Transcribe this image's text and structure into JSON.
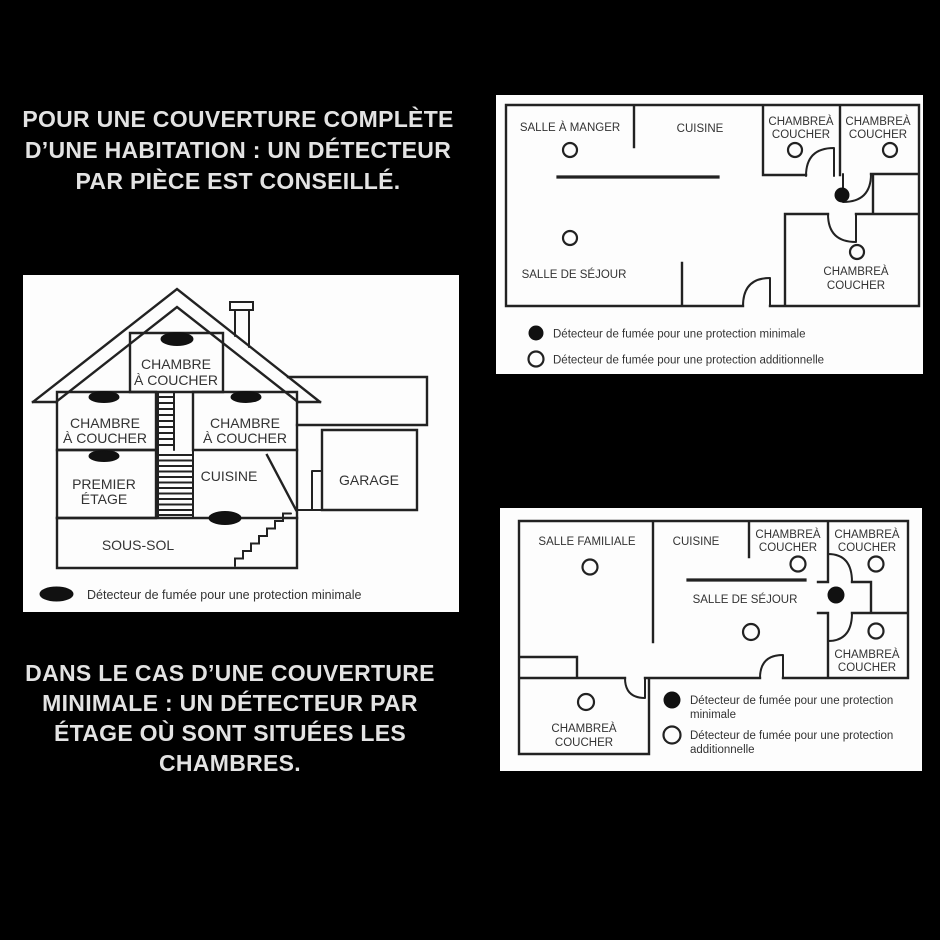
{
  "headline_top": {
    "lines": [
      "POUR UNE COUVERTURE COMPLÈTE",
      "D’UNE HABITATION : UN DÉTECTEUR",
      "PAR PIÈCE EST CONSEILLÉ."
    ]
  },
  "headline_bottom": {
    "lines": [
      "DANS LE CAS D’UNE COUVERTURE",
      "MINIMALE : UN DÉTECTEUR PAR",
      "ÉTAGE OÙ SONT SITUÉES LES",
      "CHAMBRES."
    ]
  },
  "plan_top": {
    "room_dining": "SALLE À MANGER",
    "room_kitchen": "CUISINE",
    "bedroom_line1": "CHAMBREÀ",
    "bedroom_line2": "COUCHER",
    "room_living": "SALLE DE SÉJOUR",
    "legend_minimal": "Détecteur de fumée pour une protection minimale",
    "legend_additional": "Détecteur de fumée pour une protection additionnelle"
  },
  "house": {
    "bedroom_line1": "CHAMBRE",
    "bedroom_line2": "À COUCHER",
    "first_floor_line1": "PREMIER",
    "first_floor_line2": "ÉTAGE",
    "room_kitchen": "CUISINE",
    "room_garage": "GARAGE",
    "room_basement": "SOUS-SOL",
    "legend_minimal": "Détecteur de fumée pour une protection minimale"
  },
  "plan_bottom": {
    "room_family": "SALLE FAMILIALE",
    "room_kitchen": "CUISINE",
    "bedroom_line1": "CHAMBREÀ",
    "bedroom_line2": "COUCHER",
    "room_living": "SALLE DE SÉJOUR",
    "legend_minimal_line1": "Détecteur de fumée pour une protection",
    "legend_minimal_line2": "minimale",
    "legend_additional_line1": "Détecteur de fumée pour une protection",
    "legend_additional_line2": "additionnelle"
  },
  "icons": {
    "detector_minimal": "filled-circle",
    "detector_additional": "open-circle",
    "detector_house_minimal": "filled-oval"
  },
  "colors": {
    "background": "#000000",
    "panel": "#fdfdfd",
    "line": "#222222",
    "text_dark": "#333333",
    "text_light": "#e3e3e3",
    "detector_fill": "#111111"
  }
}
